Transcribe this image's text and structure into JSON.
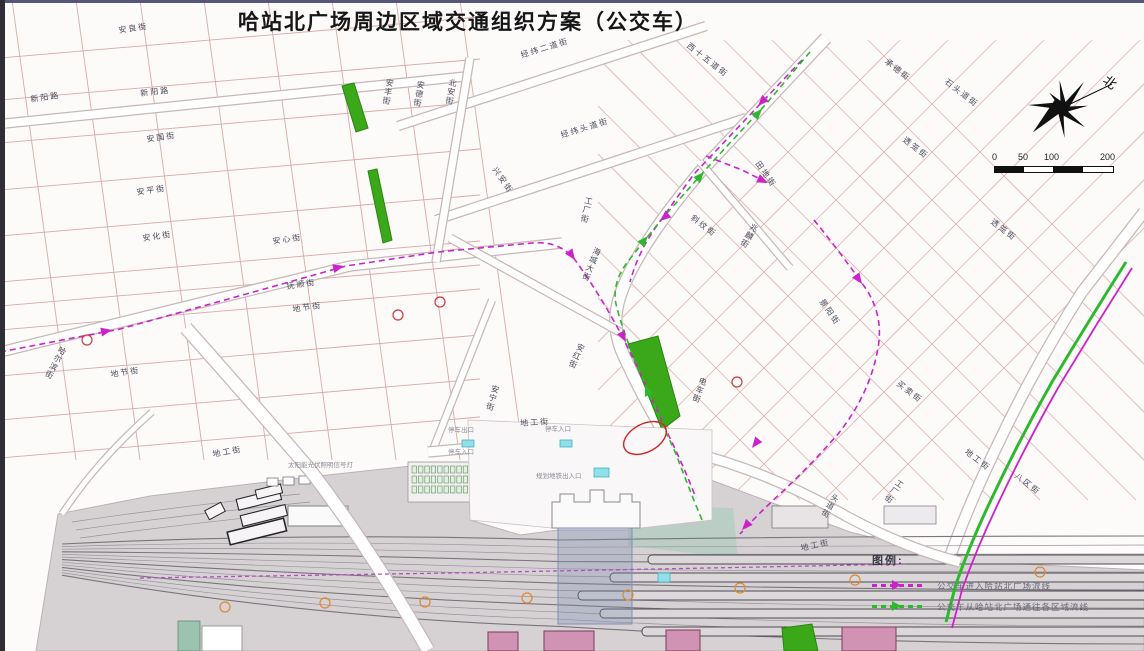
{
  "title": "哈站北广场周边区域交通组织方案（公交车）",
  "compass": {
    "north_label": "北"
  },
  "scale_bar": {
    "labels": [
      "0",
      "50",
      "100",
      "200"
    ]
  },
  "legend": {
    "title": "图例:",
    "items": [
      {
        "label": "公交车进入哈站北广场流线",
        "color": "#cc22cc"
      },
      {
        "label": "公交车从哈站北广场通往各区域流线",
        "color": "#2eb82e"
      }
    ]
  },
  "colors": {
    "route_pink": "#cc22cc",
    "route_green": "#2eb82e",
    "route_purple": "#b44fc0",
    "green_area": "#3aa818",
    "block_outline": "#d8aaa8",
    "yard_gray": "#d6d2d4",
    "marker_red": "#cc3a3a",
    "marker_orange": "#dd8833"
  },
  "map": {
    "street_labels": [
      {
        "text": "安良街",
        "x": 118,
        "y": 27,
        "rot": -8
      },
      {
        "text": "新阳路",
        "x": 30,
        "y": 96,
        "rot": -8
      },
      {
        "text": "新阳路",
        "x": 140,
        "y": 90,
        "rot": -6
      },
      {
        "text": "安国街",
        "x": 146,
        "y": 136,
        "rot": -8
      },
      {
        "text": "安平街",
        "x": 136,
        "y": 189,
        "rot": -8
      },
      {
        "text": "安化街",
        "x": 142,
        "y": 235,
        "rot": -8
      },
      {
        "text": "安心街",
        "x": 272,
        "y": 238,
        "rot": -8
      },
      {
        "text": "抚顺街",
        "x": 286,
        "y": 283,
        "rot": -8
      },
      {
        "text": "地节街",
        "x": 292,
        "y": 306,
        "rot": -8
      },
      {
        "text": "地节街",
        "x": 110,
        "y": 371,
        "rot": -8
      },
      {
        "text": "地工街",
        "x": 212,
        "y": 451,
        "rot": -10
      },
      {
        "text": "地工街",
        "x": 520,
        "y": 420,
        "rot": -4
      },
      {
        "text": "地工街",
        "x": 800,
        "y": 545,
        "rot": -12
      },
      {
        "text": "地工街",
        "x": 968,
        "y": 448,
        "rot": 38
      },
      {
        "text": "北安街",
        "x": 449,
        "y": 78,
        "rot": 10,
        "vertical": 1
      },
      {
        "text": "安丰街",
        "x": 386,
        "y": 78,
        "rot": 10,
        "vertical": 1
      },
      {
        "text": "安德街",
        "x": 417,
        "y": 80,
        "rot": 10,
        "vertical": 1
      },
      {
        "text": "哈尔滨街",
        "x": 60,
        "y": 345,
        "rot": 28,
        "vertical": 1
      },
      {
        "text": "安红街",
        "x": 578,
        "y": 342,
        "rot": 24,
        "vertical": 1
      },
      {
        "text": "海城大街",
        "x": 594,
        "y": 246,
        "rot": 22,
        "vertical": 1
      },
      {
        "text": "工厂街",
        "x": 585,
        "y": 196,
        "rot": 12,
        "vertical": 1
      },
      {
        "text": "安宁街",
        "x": 492,
        "y": 384,
        "rot": 16,
        "vertical": 1
      },
      {
        "text": "工厂街",
        "x": 898,
        "y": 478,
        "rot": 35,
        "vertical": 1
      },
      {
        "text": "电车街",
        "x": 700,
        "y": 376,
        "rot": 20,
        "vertical": 1
      },
      {
        "text": "兆麟街",
        "x": 752,
        "y": 222,
        "rot": 30,
        "vertical": 1
      },
      {
        "text": "头道街",
        "x": 833,
        "y": 492,
        "rot": 30,
        "vertical": 1
      },
      {
        "text": "经纬二道街",
        "x": 520,
        "y": 52,
        "rot": -17
      },
      {
        "text": "经纬头道街",
        "x": 560,
        "y": 132,
        "rot": -17
      },
      {
        "text": "兴安街",
        "x": 497,
        "y": 166,
        "rot": 55
      },
      {
        "text": "西十五道街",
        "x": 690,
        "y": 42,
        "rot": 38
      },
      {
        "text": "田地街",
        "x": 760,
        "y": 160,
        "rot": 55
      },
      {
        "text": "承德街",
        "x": 888,
        "y": 58,
        "rot": 38
      },
      {
        "text": "石头道街",
        "x": 948,
        "y": 78,
        "rot": 38
      },
      {
        "text": "透笼街",
        "x": 906,
        "y": 136,
        "rot": 38
      },
      {
        "text": "透笼街",
        "x": 994,
        "y": 218,
        "rot": 38
      },
      {
        "text": "买卖街",
        "x": 900,
        "y": 380,
        "rot": 38
      },
      {
        "text": "八区街",
        "x": 1018,
        "y": 472,
        "rot": 38
      },
      {
        "text": "景阳街",
        "x": 824,
        "y": 298,
        "rot": 55
      },
      {
        "text": "斜纹街",
        "x": 694,
        "y": 214,
        "rot": 38
      }
    ],
    "poi_labels": [
      {
        "text": "停车出口",
        "x": 448,
        "y": 428
      },
      {
        "text": "停车入口",
        "x": 545,
        "y": 427
      },
      {
        "text": "停车入口",
        "x": 448,
        "y": 450
      },
      {
        "text": "规划地铁出入口",
        "x": 536,
        "y": 474
      },
      {
        "text": "太阳能光伏照明信号灯",
        "x": 288,
        "y": 463
      }
    ],
    "route_arrows": [
      {
        "x": 112,
        "y": 330,
        "a": -11,
        "c": "route_pink"
      },
      {
        "x": 344,
        "y": 266,
        "a": -14,
        "c": "route_pink"
      },
      {
        "x": 575,
        "y": 260,
        "a": 55,
        "c": "route_pink"
      },
      {
        "x": 626,
        "y": 342,
        "a": 62,
        "c": "route_pink"
      },
      {
        "x": 758,
        "y": 106,
        "a": 133,
        "c": "route_pink"
      },
      {
        "x": 660,
        "y": 221,
        "a": 140,
        "c": "route_pink"
      },
      {
        "x": 768,
        "y": 183,
        "a": 25,
        "c": "route_pink"
      },
      {
        "x": 862,
        "y": 284,
        "a": 55,
        "c": "route_pink"
      },
      {
        "x": 752,
        "y": 448,
        "a": 128,
        "c": "route_pink"
      },
      {
        "x": 742,
        "y": 530,
        "a": 132,
        "c": "route_pink"
      },
      {
        "x": 648,
        "y": 236,
        "a": -49,
        "c": "route_green"
      },
      {
        "x": 704,
        "y": 172,
        "a": -48,
        "c": "route_green"
      },
      {
        "x": 762,
        "y": 109,
        "a": -47,
        "c": "route_green"
      },
      {
        "x": 645,
        "y": 385,
        "a": -112,
        "c": "route_green"
      }
    ],
    "markers": {
      "red": [
        [
          87,
          340
        ],
        [
          398,
          315
        ],
        [
          440,
          302
        ],
        [
          737,
          382
        ]
      ],
      "orange": [
        [
          225,
          607
        ],
        [
          325,
          603
        ],
        [
          425,
          602
        ],
        [
          527,
          598
        ],
        [
          628,
          595
        ],
        [
          740,
          588
        ],
        [
          855,
          580
        ],
        [
          1040,
          572
        ]
      ]
    }
  }
}
